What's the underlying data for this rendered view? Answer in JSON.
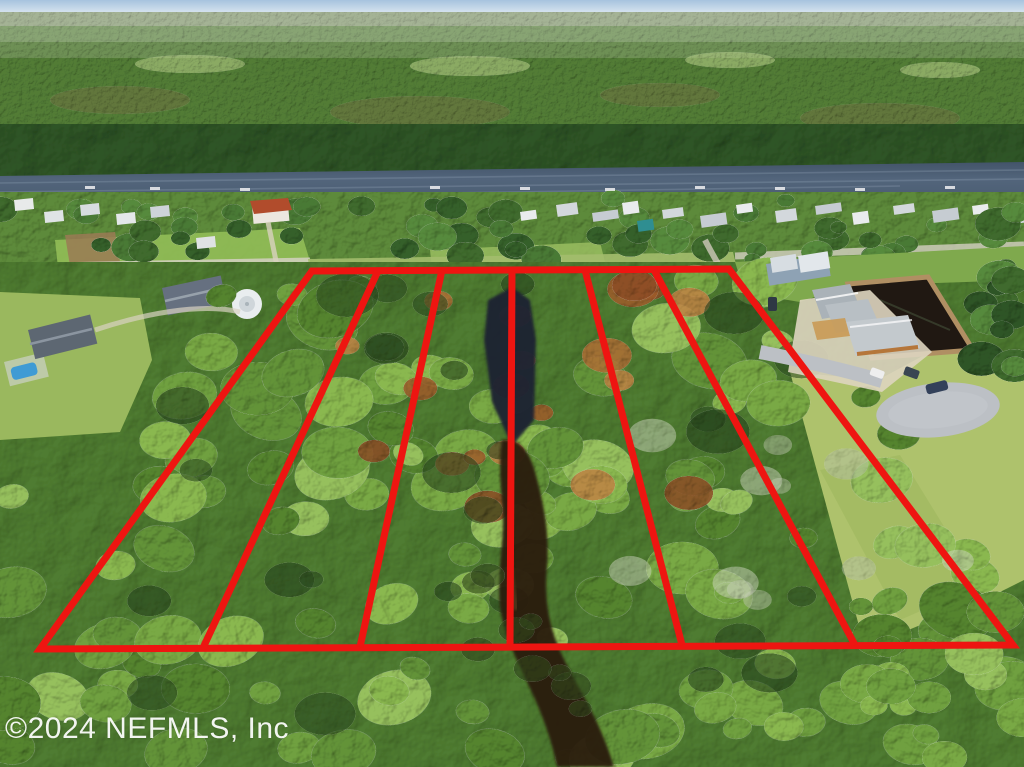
{
  "watermark": {
    "text": "©2024 NEFMLS, Inc",
    "color": "#ffffff"
  },
  "overlay": {
    "color": "#ee1511",
    "stroke_width": 7,
    "boundary_points": "312,271 729,269 1013,645 40,649",
    "lot_lines": [
      {
        "points": "378,271 203,648"
      },
      {
        "points": "442,270 360,647"
      },
      {
        "points": "512,270 510,646"
      },
      {
        "points": "585,270 682,645"
      },
      {
        "points": "654,270 855,645"
      }
    ],
    "lot_count": 6
  },
  "palette": {
    "sky_top": "#a6c3de",
    "sky_horizon": "#eaf1f5",
    "river": "#4d5f76",
    "creek_pool": "#1c2433",
    "creek_water": "#2c1d10",
    "pond": "#201812",
    "pond_wall": "#b08f63",
    "lawn": "#aec26c",
    "road": "#bcc0c5",
    "canopy": "#79a944",
    "rust_foliage": "#a05c2c"
  }
}
